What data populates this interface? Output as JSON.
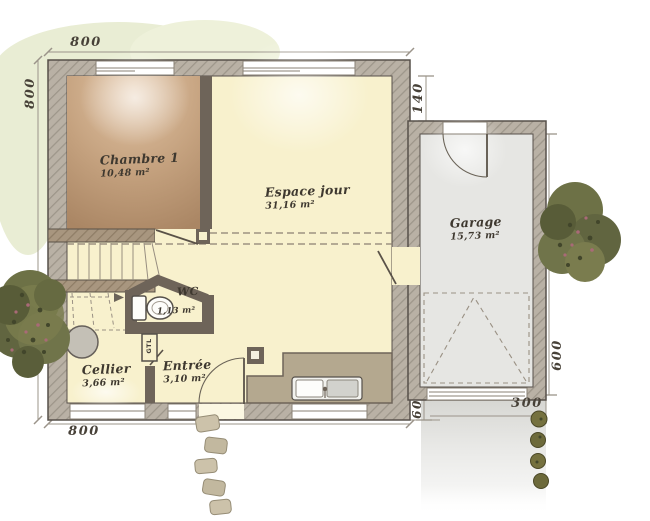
{
  "plan": {
    "rooms": {
      "chambre": {
        "name": "Chambre 1",
        "area": "10,48 m²"
      },
      "espace_jour": {
        "name": "Espace jour",
        "area": "31,16 m²"
      },
      "wc": {
        "name": "WC",
        "area": "1,13 m²"
      },
      "cellier": {
        "name": "Cellier",
        "area": "3,66 m²"
      },
      "entree": {
        "name": "Entrée",
        "area": "3,10 m²"
      },
      "garage": {
        "name": "Garage",
        "area": "15,73 m²"
      }
    },
    "annotations": {
      "gtl": "GTL"
    },
    "dimensions": {
      "top_width": "800",
      "left_depth": "800",
      "bottom_width": "800",
      "house_garage_gap": "140",
      "garage_right_depth": "600",
      "garage_width": "300",
      "garage_bottom_offset": "60"
    },
    "colors": {
      "exterior_wall": "#b9b1a5",
      "bearing_wall": "#a8967f",
      "interior_wall": "#6e6459",
      "wall_edge": "#57504a",
      "living_floor": "#f8f1cd",
      "bedroom_floor": "#c2a07d",
      "garage_floor": "#e6e6e3",
      "counter": "#b4a88f",
      "vegetation": "#6d7146",
      "hedge": "#e9edd4",
      "driveway": "#d6d6d2",
      "label_ink": "#3e382f"
    }
  }
}
